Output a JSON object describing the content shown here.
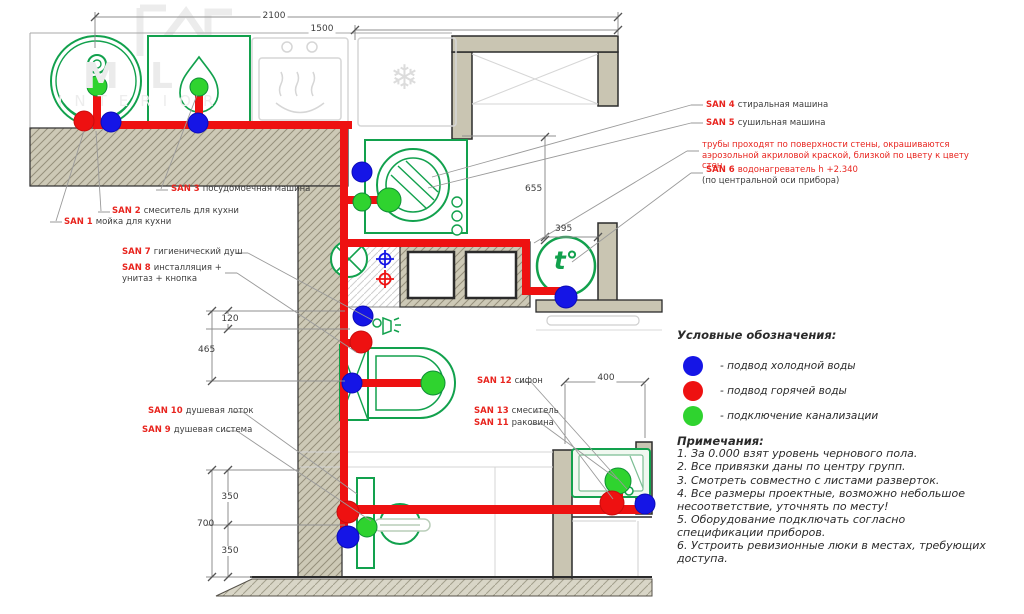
{
  "watermark": {
    "monogram_m": "M",
    "monogram_l": "L",
    "brand": "INTERIOR"
  },
  "dimensions": {
    "top_2100": "2100",
    "top_1500": "1500",
    "right_655": "655",
    "right_395": "395",
    "left_120": "120",
    "left_465": "465",
    "basin_400": "400",
    "bottom_350a": "350",
    "bottom_700": "700",
    "bottom_350b": "350"
  },
  "labels": {
    "san1": {
      "num": "SAN 1",
      "desc": "мойка для кухни"
    },
    "san2": {
      "num": "SAN 2",
      "desc": "смеситель для кухни"
    },
    "san3": {
      "num": "SAN 3",
      "desc": "посудомоечная машина"
    },
    "san4": {
      "num": "SAN 4",
      "desc": "стиральная машина"
    },
    "san5": {
      "num": "SAN 5",
      "desc": "сушильная машина"
    },
    "san6": {
      "num": "SAN 6",
      "desc": "водонагреватель h +2.340",
      "sub": "(по центральной оси прибора)"
    },
    "san7": {
      "num": "SAN 7",
      "desc": "гигиенический душ"
    },
    "san8": {
      "num": "SAN 8",
      "desc": "инсталляция +",
      "sub": "унитаз + кнопка"
    },
    "san9": {
      "num": "SAN 9",
      "desc": "душевая система"
    },
    "san10": {
      "num": "SAN 10",
      "desc": "душевая лоток"
    },
    "san11": {
      "num": "SAN 11",
      "desc": "раковина"
    },
    "san12": {
      "num": "SAN 12",
      "desc": "сифон"
    },
    "san13": {
      "num": "SAN 13",
      "desc": "смеситель"
    },
    "pipe_note": "трубы проходят по поверхности стены, окрашиваются аэрозольной акриловой краской, близкой по цвету к цвету стен"
  },
  "symbols": {
    "water_heater": "t°",
    "fridge_snowflake": "❄"
  },
  "legend": {
    "title": "Условные обозначения:",
    "items": [
      {
        "name": "cold-water",
        "color": "#1515e6",
        "text": "- подвод холодной воды"
      },
      {
        "name": "hot-water",
        "color": "#ee1111",
        "text": "- подвод горячей воды"
      },
      {
        "name": "sewer",
        "color": "#2fd32f",
        "text": "- подключение канализации"
      }
    ]
  },
  "notes": {
    "title": "Примечания:",
    "items": [
      "1. За 0.000 взят уровень чернового пола.",
      "2. Все привязки даны по центру групп.",
      "3. Смотреть совместно с листами разверток.",
      "4. Все размеры проектные, возможно небольшое несоответствие, уточнять по месту!",
      "5. Оборудование подключать согласно спецификации приборов.",
      "6. Устроить ревизионные люки в местах, требующих доступа."
    ]
  },
  "colors": {
    "pipe_hot": "#ee1111",
    "cold": "#1515e6",
    "sewer": "#2fd32f",
    "fixture_green": "#12a14d",
    "wall_fill": "#cdc9b6",
    "label_red": "#e8251f"
  }
}
